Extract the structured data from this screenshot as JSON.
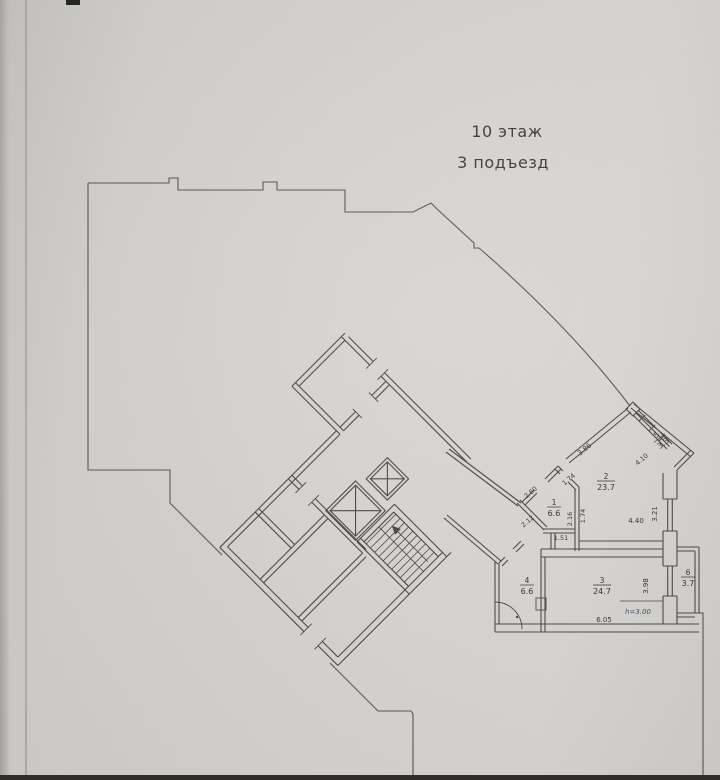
{
  "title": {
    "floor": "10 этаж",
    "entrance": "3 подъезд"
  },
  "rooms": {
    "r1": {
      "num": "1",
      "area": "6.6"
    },
    "r2": {
      "num": "2",
      "area": "23.7"
    },
    "r3": {
      "num": "3",
      "area": "24.7"
    },
    "r4": {
      "num": "4",
      "area": "6.6"
    },
    "r5": {
      "num": "5",
      "area": "3.3"
    },
    "r6": {
      "num": "6",
      "area": "3.7"
    }
  },
  "dims": {
    "w386": "3.86",
    "w174d": "1.74",
    "w260": "2.60",
    "w212": "2.12",
    "w151": "1.51",
    "w216": "2.16",
    "w174v": "1.74",
    "w440": "4.40",
    "w321": "3.21",
    "w410": "4.10",
    "w398": "3.98",
    "w605": "6.05",
    "height_note": "h=3.00"
  },
  "colors": {
    "paper": "#d3d1ce",
    "ink": "#47443f",
    "blue_ink": "#3c4960"
  }
}
